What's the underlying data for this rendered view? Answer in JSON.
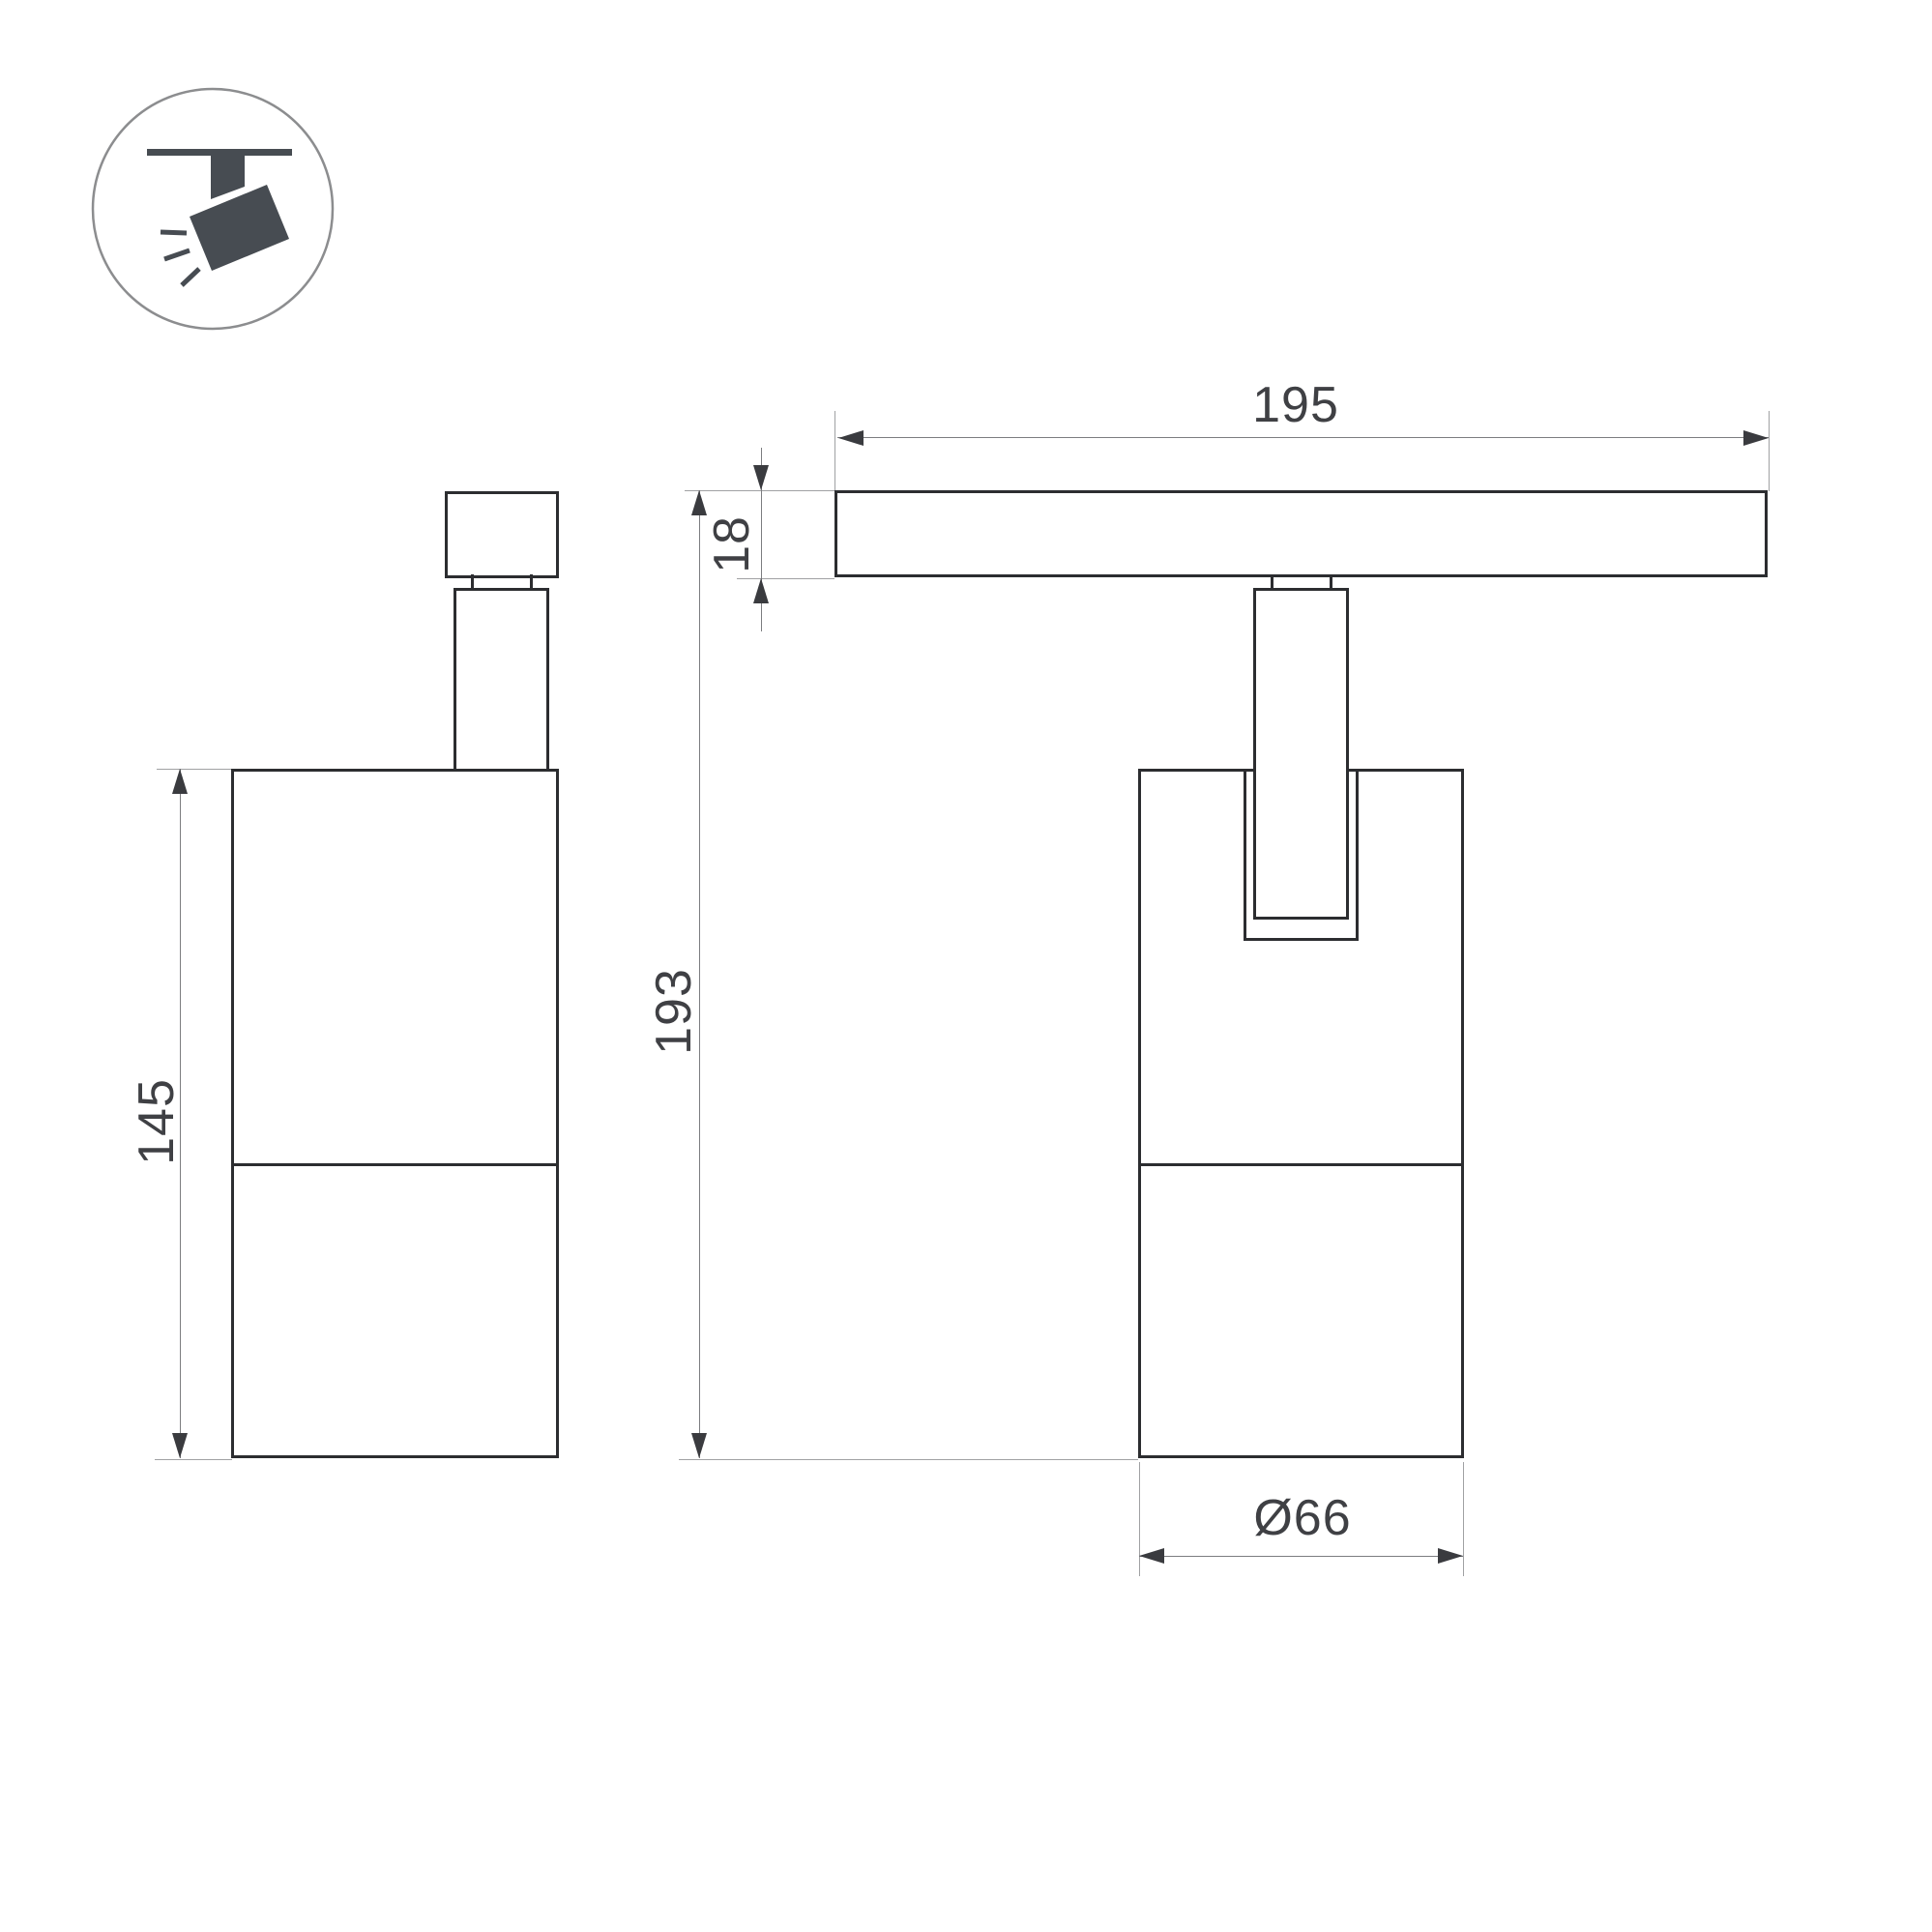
{
  "page": {
    "background": "#ffffff"
  },
  "icon": {
    "name": "track-spotlight-pictogram",
    "description": "ceiling track with tilted spotlight emitting rays",
    "shape_color": "#474c52",
    "circle_stroke": "#8c8d8f"
  },
  "views": {
    "side_view": {
      "name": "side-view",
      "parts": [
        "track-adapter-box",
        "neck",
        "stem",
        "lamp-body",
        "body-divider"
      ]
    },
    "front_view": {
      "name": "front-view",
      "parts": [
        "track-rail",
        "neck",
        "yoke-stem",
        "slot",
        "lamp-body",
        "body-divider"
      ]
    }
  },
  "dimensions": {
    "track_length": {
      "label": "195"
    },
    "track_height": {
      "label": "18"
    },
    "total_height": {
      "label": "193"
    },
    "body_height": {
      "label": "145"
    },
    "body_diameter": {
      "label": "Ø66"
    }
  },
  "colors": {
    "outline": "#2c2d30",
    "dim_line": "#7c7d80",
    "extension_line": "#a0a1a3",
    "arrow": "#3a3b3f",
    "label_text": "#3f4044"
  }
}
